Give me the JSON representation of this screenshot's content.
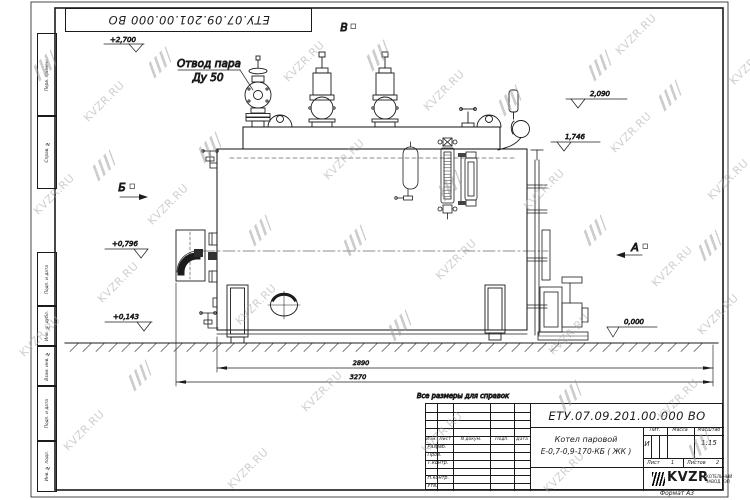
{
  "watermark": {
    "text": "KVZR.RU"
  },
  "top_stamp": {
    "number": "ЕТУ.07.09.201.00.000  ВО"
  },
  "frame": {
    "left_cells": [
      "Перв. примен.",
      "Справ. №",
      "Подп. и дата",
      "Инв. № дубл.",
      "Взам. инв. №",
      "Подп. и дата",
      "Инв. № подл."
    ]
  },
  "drawing": {
    "callout_line1": "Отвод пара",
    "callout_line2": "Ду 50",
    "view_top": "В",
    "view_left": "Б",
    "view_right": "А",
    "elev_2700": "+2,700",
    "elev_2090": "2,090",
    "elev_1746": "1,746",
    "elev_0796": "+0,796",
    "elev_0143": "+0,143",
    "elev_0000": "0,000",
    "dim_width": "2890",
    "dim_total": "3270",
    "note": "Все размеры для справок"
  },
  "title_block": {
    "number": "ЕТУ.07.09.201.00.000  ВО",
    "product_line1": "Котел паровой",
    "product_line2": "Е-0,7-0,9-170-КБ ( ЖК )",
    "col_izm": "Изм.",
    "col_list": "Лист",
    "col_ndoc": "N докум.",
    "col_podp": "Подп.",
    "col_data": "Дата",
    "row_razrab": "Разраб.",
    "row_prov": "Пров.",
    "row_tkontr": "Т.контр.",
    "row_nkontr": "Н.контр.",
    "row_utv": "Утв.",
    "lit_label": "Лит.",
    "massa_label": "Масса",
    "masshtab_label": "Масштаб",
    "lit_value": "И",
    "masshtab_value": "1:15",
    "list_label": "Лист",
    "list_value": "1",
    "listov_label": "Листов",
    "listov_value": "2",
    "logo": "KVZR",
    "logo_line1": "КОТЕЛЬНЫЙ",
    "logo_line2": "ЗАВОД РЭП",
    "format_note": "Формат А3"
  }
}
